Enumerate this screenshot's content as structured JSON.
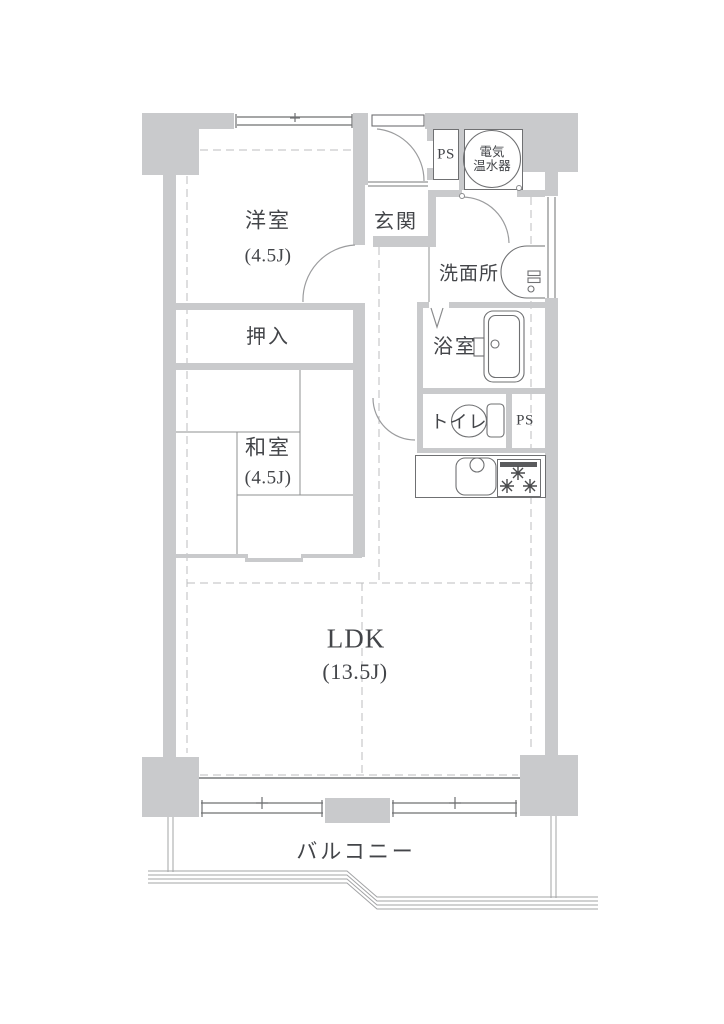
{
  "plan": {
    "western_room": {
      "label": "洋室",
      "size": "(4.5J)"
    },
    "entrance": {
      "label": "玄関"
    },
    "closet": {
      "label": "押入"
    },
    "japanese_room": {
      "label": "和室",
      "size": "(4.5J)"
    },
    "washroom": {
      "label": "洗面所"
    },
    "bathroom": {
      "label": "浴室"
    },
    "toilet": {
      "label": "トイレ"
    },
    "ldk": {
      "label": "LDK",
      "size": "(13.5J)"
    },
    "balcony": {
      "label": "バルコニー"
    },
    "pipe_space_top": {
      "label": "PS"
    },
    "pipe_space_mid": {
      "label": "PS"
    },
    "water_heater": {
      "label_line1": "電気",
      "label_line2": "温水器"
    },
    "colors": {
      "wall": "#c9cacc",
      "line": "#6f7072",
      "dash": "#bcbdbf",
      "text": "#434549"
    }
  }
}
